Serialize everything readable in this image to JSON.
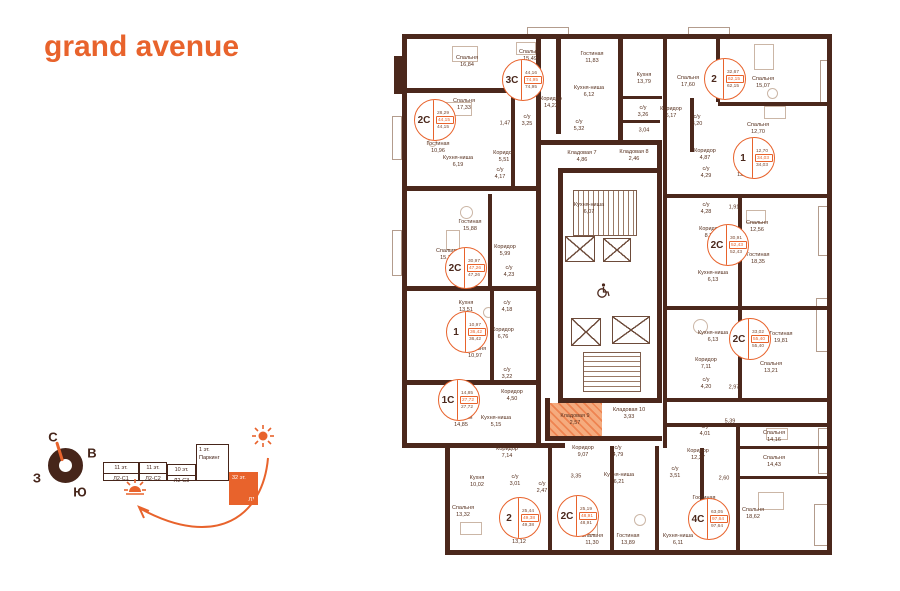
{
  "logo": {
    "text": "grand avenue",
    "color": "#e8632c"
  },
  "compass": {
    "north": "С",
    "east": "В",
    "west": "З",
    "south": "Ю"
  },
  "schematic": {
    "blocks": [
      {
        "floors": "11 эт.",
        "name": "Л2-С1",
        "highlighted": false
      },
      {
        "floors": "11 эт.",
        "name": "Л2-С2",
        "highlighted": false
      },
      {
        "floors": "10 эт.",
        "name": "Л2-С3",
        "highlighted": false
      },
      {
        "floors": "1 эт.",
        "name": "Паркинг",
        "highlighted": false
      },
      {
        "floors": "32 эт.",
        "name": "Л1",
        "highlighted": true
      }
    ]
  },
  "colors": {
    "accent": "#e8632c",
    "wall": "#4b281c",
    "highlight_fill": "#f5ab7e"
  },
  "plan": {
    "units": [
      {
        "type": "3С",
        "living": "44,16",
        "total": "74,95",
        "total2": "74,95",
        "x": 523,
        "y": 80
      },
      {
        "type": "2С",
        "living": "28,29",
        "total": "44,15",
        "total2": "44,15",
        "x": 435,
        "y": 120
      },
      {
        "type": "2",
        "living": "32,67",
        "total": "62,15",
        "total2": "62,15",
        "x": 725,
        "y": 79
      },
      {
        "type": "1",
        "living": "12,70",
        "total": "34,03",
        "total2": "34,03",
        "x": 754,
        "y": 158
      },
      {
        "type": "2С",
        "living": "30,91",
        "total": "52,43",
        "total2": "52,43",
        "x": 728,
        "y": 245
      },
      {
        "type": "2С",
        "living": "33,02",
        "total": "55,40",
        "total2": "55,40",
        "x": 750,
        "y": 339
      },
      {
        "type": "4С",
        "living": "63,05",
        "total": "97,64",
        "total2": "97,64",
        "x": 709,
        "y": 519
      },
      {
        "type": "2С",
        "living": "25,19",
        "total": "48,91",
        "total2": "48,91",
        "x": 578,
        "y": 516
      },
      {
        "type": "2",
        "living": "25,44",
        "total": "49,38",
        "total2": "49,38",
        "x": 520,
        "y": 518
      },
      {
        "type": "1С",
        "living": "14,85",
        "total": "27,72",
        "total2": "27,72",
        "x": 459,
        "y": 400
      },
      {
        "type": "1",
        "living": "10,97",
        "total": "36,42",
        "total2": "36,42",
        "x": 467,
        "y": 332
      },
      {
        "type": "2С",
        "living": "30,97",
        "total": "47,26",
        "total2": "47,26",
        "x": 466,
        "y": 268
      }
    ],
    "rooms": [
      {
        "n": "Спальня",
        "a": "16,84",
        "x": 467,
        "y": 62
      },
      {
        "n": "Спальня",
        "a": "17,33",
        "x": 464,
        "y": 105
      },
      {
        "n": "Гостиная",
        "a": "10,96",
        "x": 438,
        "y": 148
      },
      {
        "n": "Кухня-ниша",
        "a": "6,19",
        "x": 458,
        "y": 162
      },
      {
        "n": "Спальня",
        "a": "15,49",
        "x": 530,
        "y": 56
      },
      {
        "n": "Гостиная",
        "a": "11,83",
        "x": 592,
        "y": 58
      },
      {
        "n": "Кухня-ниша",
        "a": "6,12",
        "x": 589,
        "y": 92
      },
      {
        "n": "Коридор",
        "a": "14,23",
        "x": 551,
        "y": 103
      },
      {
        "n": "с/у",
        "a": "3,25",
        "x": 527,
        "y": 121
      },
      {
        "n": "",
        "a": "1,47",
        "x": 505,
        "y": 124
      },
      {
        "n": "с/у",
        "a": "5,32",
        "x": 579,
        "y": 126
      },
      {
        "n": "Коридор",
        "a": "5,51",
        "x": 504,
        "y": 157
      },
      {
        "n": "Кладовая 7",
        "a": "4,86",
        "x": 582,
        "y": 157
      },
      {
        "n": "Кладовая 8",
        "a": "2,46",
        "x": 634,
        "y": 156
      },
      {
        "n": "с/у",
        "a": "4,17",
        "x": 500,
        "y": 174
      },
      {
        "n": "Кухня-ниша",
        "a": "6,07",
        "x": 589,
        "y": 209
      },
      {
        "n": "Гостиная",
        "a": "15,88",
        "x": 470,
        "y": 226
      },
      {
        "n": "Спальня",
        "a": "15,19",
        "x": 447,
        "y": 255
      },
      {
        "n": "Коридор",
        "a": "5,99",
        "x": 505,
        "y": 251
      },
      {
        "n": "с/у",
        "a": "4,23",
        "x": 509,
        "y": 272
      },
      {
        "n": "Кухня",
        "a": "13,51",
        "x": 466,
        "y": 307
      },
      {
        "n": "с/у",
        "a": "4,18",
        "x": 507,
        "y": 307
      },
      {
        "n": "Коридор",
        "a": "6,76",
        "x": 503,
        "y": 334
      },
      {
        "n": "Спальня",
        "a": "10,97",
        "x": 475,
        "y": 353
      },
      {
        "n": "с/у",
        "a": "3,22",
        "x": 507,
        "y": 374
      },
      {
        "n": "Коридор",
        "a": "4,50",
        "x": 512,
        "y": 396
      },
      {
        "n": "Гостиная",
        "a": "14,85",
        "x": 461,
        "y": 422
      },
      {
        "n": "Кухня-ниша",
        "a": "5,15",
        "x": 496,
        "y": 422
      },
      {
        "n": "Кладовая 9",
        "a": "2,57",
        "x": 575,
        "y": 420,
        "hl": true
      },
      {
        "n": "Кладовая 10",
        "a": "3,93",
        "x": 629,
        "y": 414
      },
      {
        "n": "Коридор",
        "a": "7,14",
        "x": 507,
        "y": 453
      },
      {
        "n": "Кухня",
        "a": "10,02",
        "x": 477,
        "y": 482
      },
      {
        "n": "с/у",
        "a": "3,01",
        "x": 515,
        "y": 481
      },
      {
        "n": "с/у",
        "a": "2,47",
        "x": 542,
        "y": 488
      },
      {
        "n": "Спальня",
        "a": "13,32",
        "x": 463,
        "y": 512
      },
      {
        "n": "Спальня",
        "a": "13,12",
        "x": 519,
        "y": 539
      },
      {
        "n": "Коридор",
        "a": "9,07",
        "x": 583,
        "y": 452
      },
      {
        "n": "",
        "a": "3,35",
        "x": 576,
        "y": 477
      },
      {
        "n": "Спальня",
        "a": "11,30",
        "x": 592,
        "y": 540
      },
      {
        "n": "Кухня",
        "a": "13,79",
        "x": 644,
        "y": 79
      },
      {
        "n": "Спальня",
        "a": "17,60",
        "x": 688,
        "y": 82
      },
      {
        "n": "Спальня",
        "a": "15,07",
        "x": 763,
        "y": 83
      },
      {
        "n": "с/у",
        "a": "3,26",
        "x": 643,
        "y": 112
      },
      {
        "n": "Коридор",
        "a": "6,17",
        "x": 671,
        "y": 113
      },
      {
        "n": "",
        "a": "3,04",
        "x": 644,
        "y": 131
      },
      {
        "n": "с/у",
        "a": "3,20",
        "x": 697,
        "y": 121
      },
      {
        "n": "Спальня",
        "a": "12,70",
        "x": 758,
        "y": 129
      },
      {
        "n": "Коридор",
        "a": "4,87",
        "x": 705,
        "y": 155
      },
      {
        "n": "Кухня",
        "a": "12,18",
        "x": 744,
        "y": 172
      },
      {
        "n": "с/у",
        "a": "4,29",
        "x": 706,
        "y": 173
      },
      {
        "n": "с/у",
        "a": "4,28",
        "x": 706,
        "y": 209
      },
      {
        "n": "",
        "a": "1,91",
        "x": 734,
        "y": 208
      },
      {
        "n": "Спальня",
        "a": "12,56",
        "x": 757,
        "y": 227
      },
      {
        "n": "Коридор",
        "a": "8,20",
        "x": 710,
        "y": 233
      },
      {
        "n": "Гостиная",
        "a": "18,35",
        "x": 758,
        "y": 259
      },
      {
        "n": "Кухня-ниша",
        "a": "6,13",
        "x": 713,
        "y": 277
      },
      {
        "n": "Кухня-ниша",
        "a": "6,13",
        "x": 713,
        "y": 337
      },
      {
        "n": "Гостиная",
        "a": "19,81",
        "x": 781,
        "y": 338
      },
      {
        "n": "Коридор",
        "a": "7,11",
        "x": 706,
        "y": 364
      },
      {
        "n": "Спальня",
        "a": "13,21",
        "x": 771,
        "y": 368
      },
      {
        "n": "с/у",
        "a": "4,20",
        "x": 706,
        "y": 384
      },
      {
        "n": "",
        "a": "2,97",
        "x": 734,
        "y": 388
      },
      {
        "n": "",
        "a": "5,39",
        "x": 730,
        "y": 422
      },
      {
        "n": "с/у",
        "a": "4,01",
        "x": 705,
        "y": 431
      },
      {
        "n": "с/у",
        "a": "4,79",
        "x": 618,
        "y": 452
      },
      {
        "n": "Кухня-ниша",
        "a": "6,21",
        "x": 619,
        "y": 479
      },
      {
        "n": "Коридор",
        "a": "12,37",
        "x": 698,
        "y": 455
      },
      {
        "n": "Спальня",
        "a": "14,16",
        "x": 774,
        "y": 437
      },
      {
        "n": "Спальня",
        "a": "14,43",
        "x": 774,
        "y": 462
      },
      {
        "n": "с/у",
        "a": "3,51",
        "x": 675,
        "y": 473
      },
      {
        "n": "",
        "a": "2,60",
        "x": 724,
        "y": 479
      },
      {
        "n": "Гостиная",
        "a": "15,84",
        "x": 704,
        "y": 502
      },
      {
        "n": "Спальня",
        "a": "18,62",
        "x": 753,
        "y": 514
      },
      {
        "n": "Гостиная",
        "a": "13,89",
        "x": 628,
        "y": 540
      },
      {
        "n": "Кухня-ниша",
        "a": "6,11",
        "x": 678,
        "y": 540
      }
    ]
  }
}
